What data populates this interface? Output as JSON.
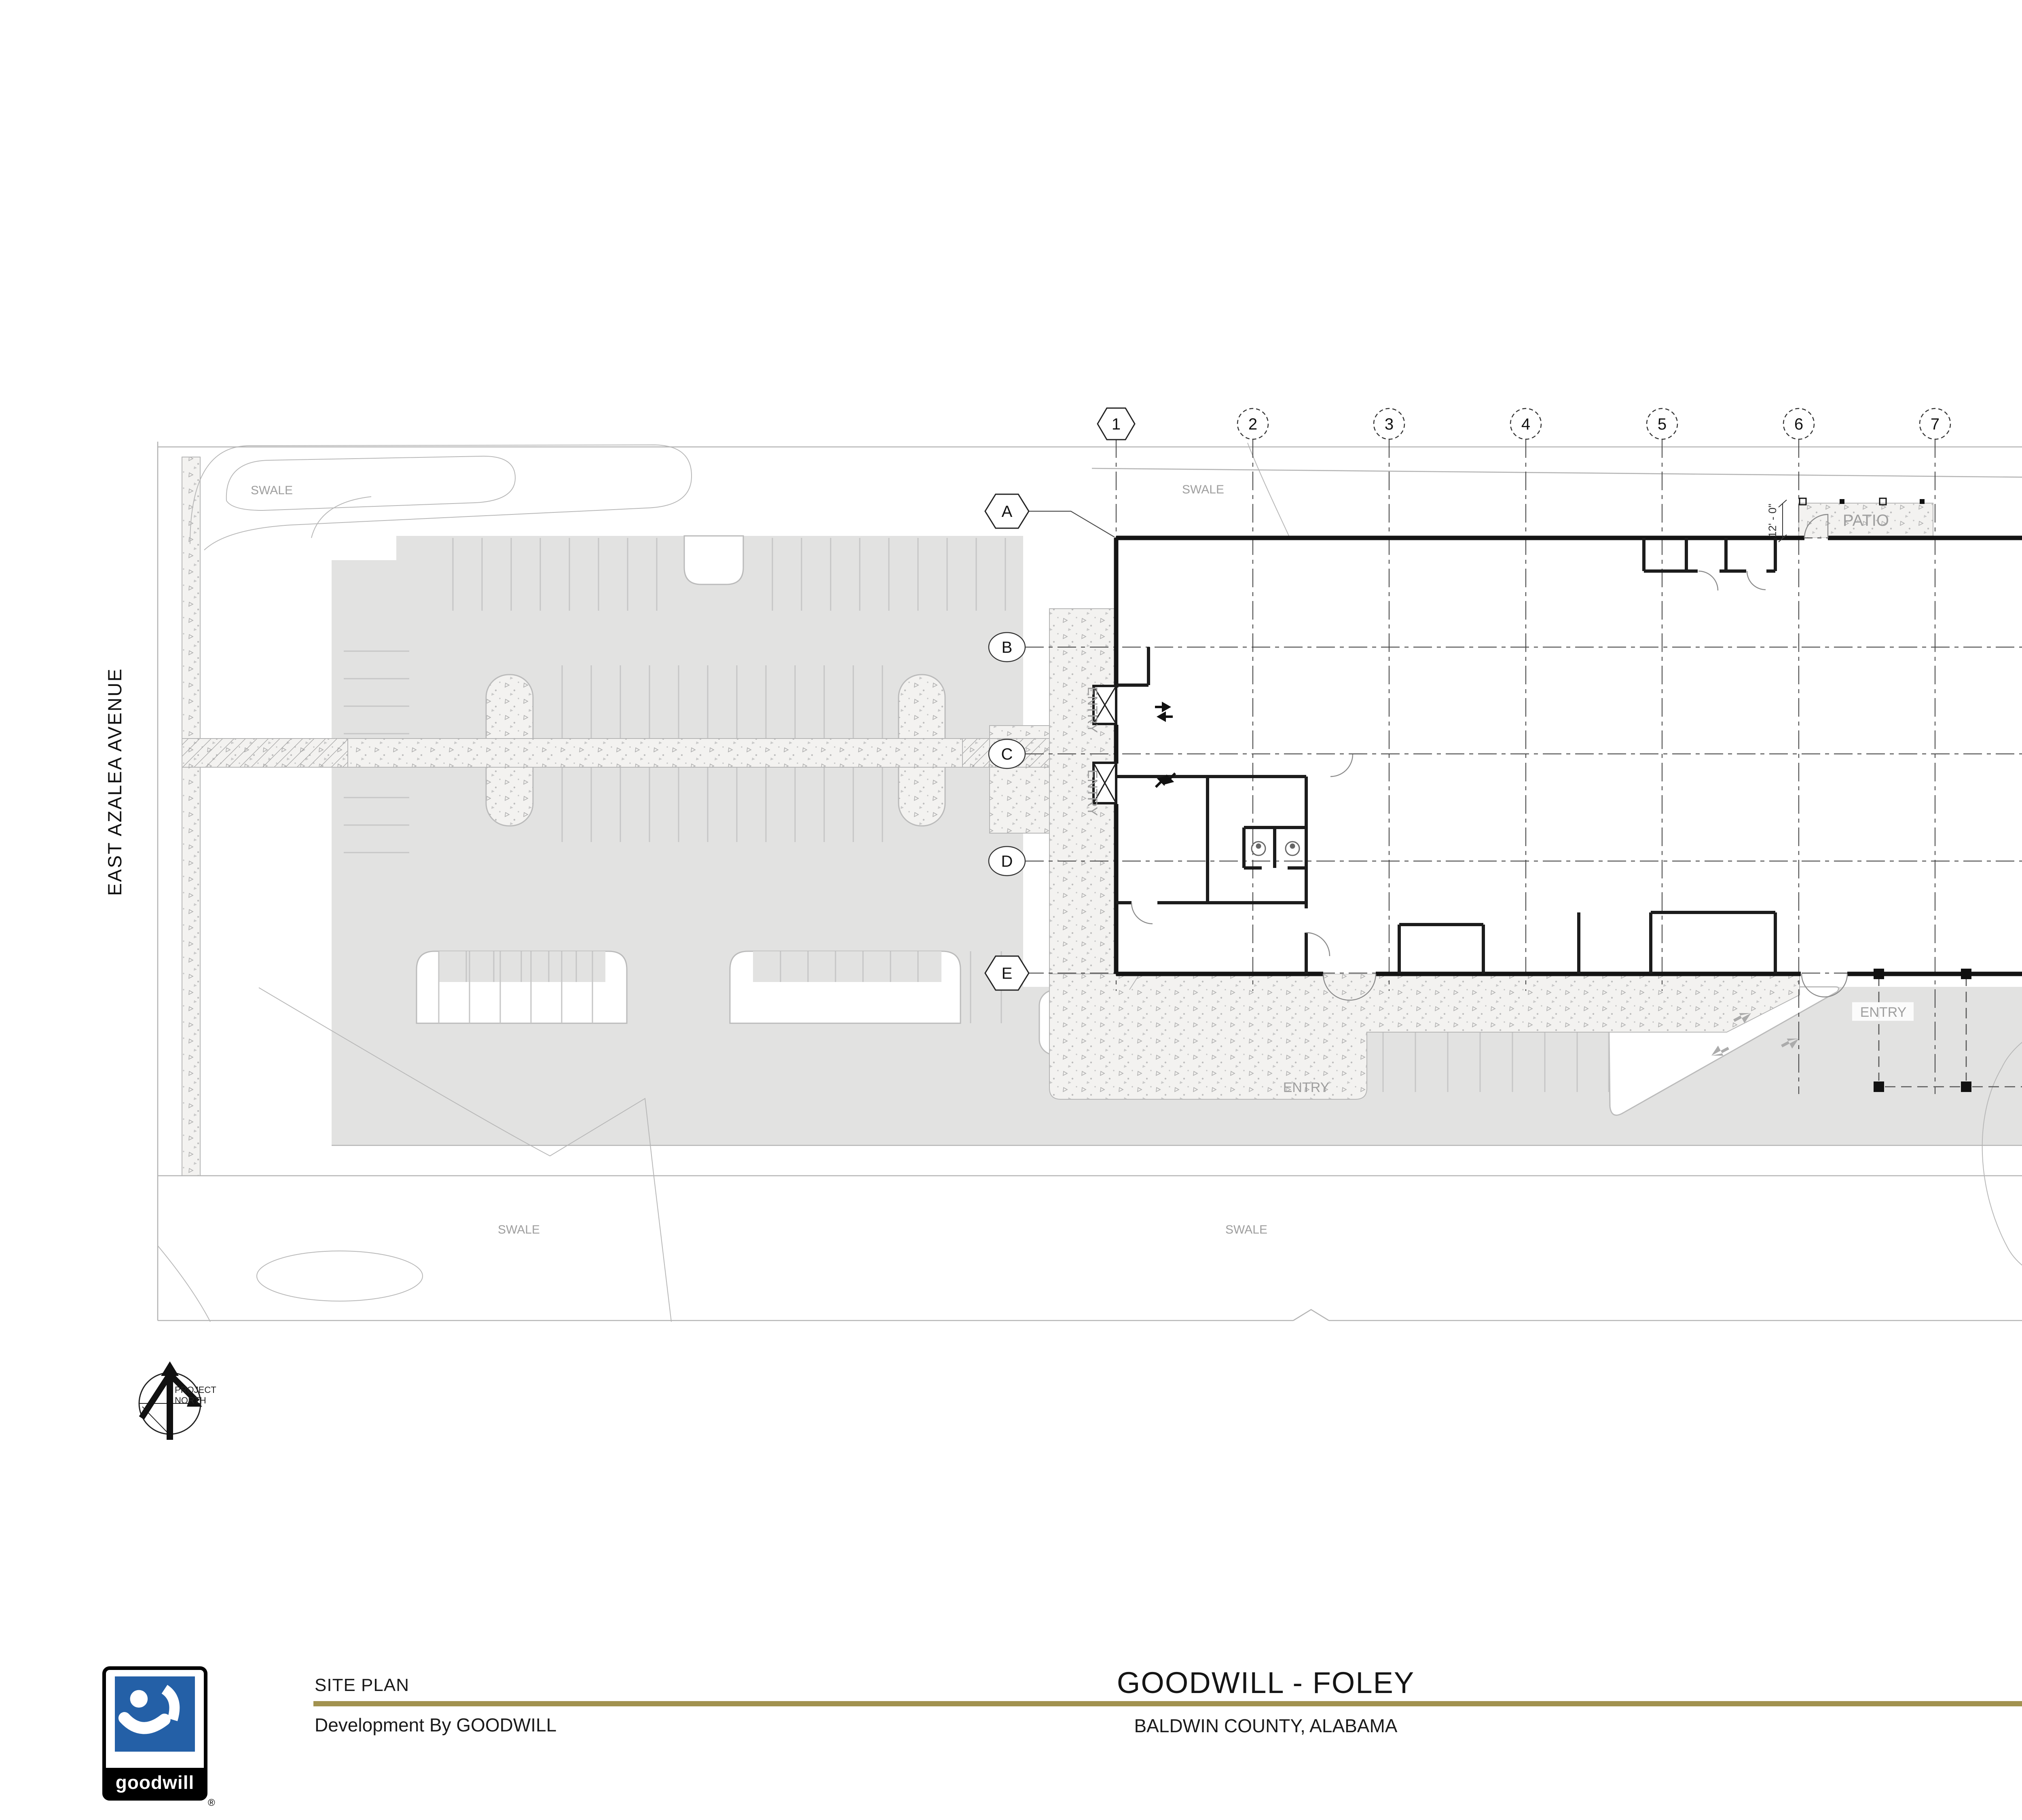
{
  "street": {
    "name": "EAST AZALEA AVENUE"
  },
  "north_arrow": {
    "line1": "PROJECT",
    "line2": "NORTH"
  },
  "grid": {
    "cols": [
      "1",
      "2",
      "3",
      "4",
      "5",
      "6",
      "7",
      "8",
      "9"
    ],
    "rows": [
      "A",
      "B",
      "C",
      "D",
      "E"
    ]
  },
  "labels": {
    "swale": "SWALE",
    "entry": "ENTRY",
    "patio": "PATIO",
    "patio_dim": "12' - 0\""
  },
  "title_block": {
    "sheet_title": "SITE PLAN",
    "sheet_subtitle": "Development By GOODWILL",
    "project_title": "GOODWILL - FOLEY",
    "project_location": "BALDWIN COUNTY, ALABAMA",
    "date": "July 19, 2023",
    "project_number": "2023231.00",
    "accent_color": "#a2924f"
  },
  "goodwill_logo": {
    "wordmark": "goodwill",
    "registered": "®",
    "blue": "#2460a7"
  },
  "architect_logo": {
    "line1": "RANDALL",
    "line2": "PAULSON",
    "line3": "architects",
    "years": "YEARS",
    "navy": "#2b3272",
    "orange": "#e8502a",
    "gold": "#a8924c",
    "yellow": "#f2c200",
    "silver": "#b9b9b9",
    "text_gold": "#ac8c1e"
  }
}
